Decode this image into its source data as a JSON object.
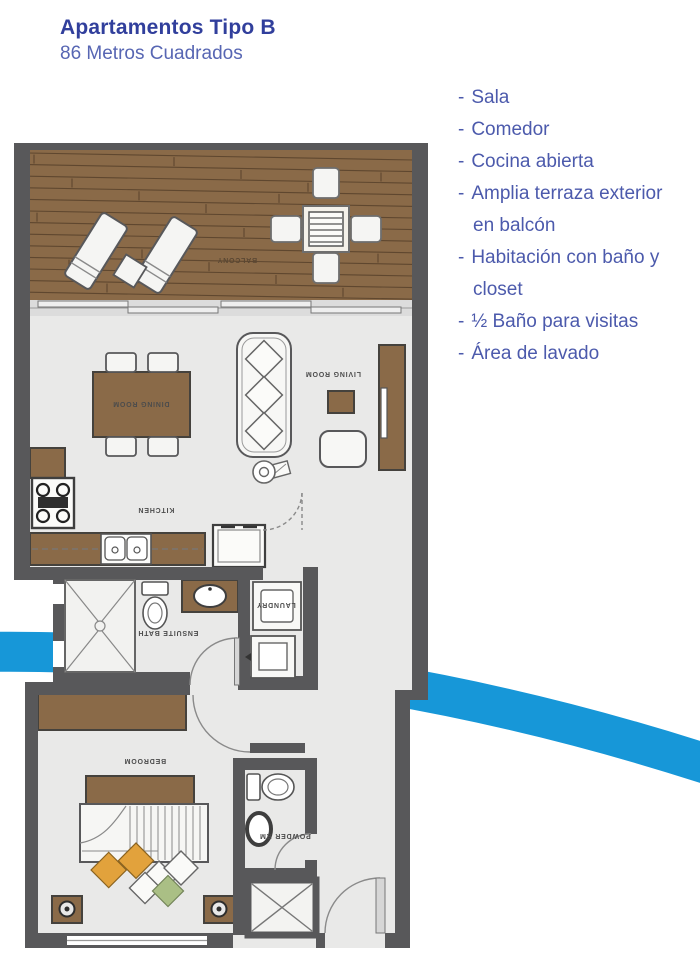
{
  "page": {
    "title": "Apartamentos Tipo B",
    "subtitle": "86 Metros Cuadrados"
  },
  "list": {
    "bullet": "-"
  },
  "features": [
    "Sala",
    "Comedor",
    "Cocina abierta",
    "Amplia terraza exterior en balcón",
    "Habitación con baño y closet",
    "½ Baño para visitas",
    "Área de lavado"
  ],
  "floorplan": {
    "labels": {
      "balcony": "BALCONY",
      "dining": "DINING ROOM",
      "living": "LIVING ROOM",
      "kitchen": "KITCHEN",
      "ensuite": "ENSUITE BATH",
      "laundry": "LAUNDRY",
      "bedroom": "BEDROOM",
      "powder": "POWDER RM"
    }
  },
  "colors": {
    "title_blue": "#313f9c",
    "text_blue": "#4c5aac",
    "swoosh_blue": "#1797d8",
    "wood": "#8a6a48",
    "wood_line": "#5f472f",
    "wall": "#58585a",
    "floor": "#e9e9e8",
    "label_gray": "#4c4c4c",
    "balcony_label": "#5a4733",
    "pillow_orange": "#e2a23c",
    "pillow_green": "#aabf85"
  }
}
